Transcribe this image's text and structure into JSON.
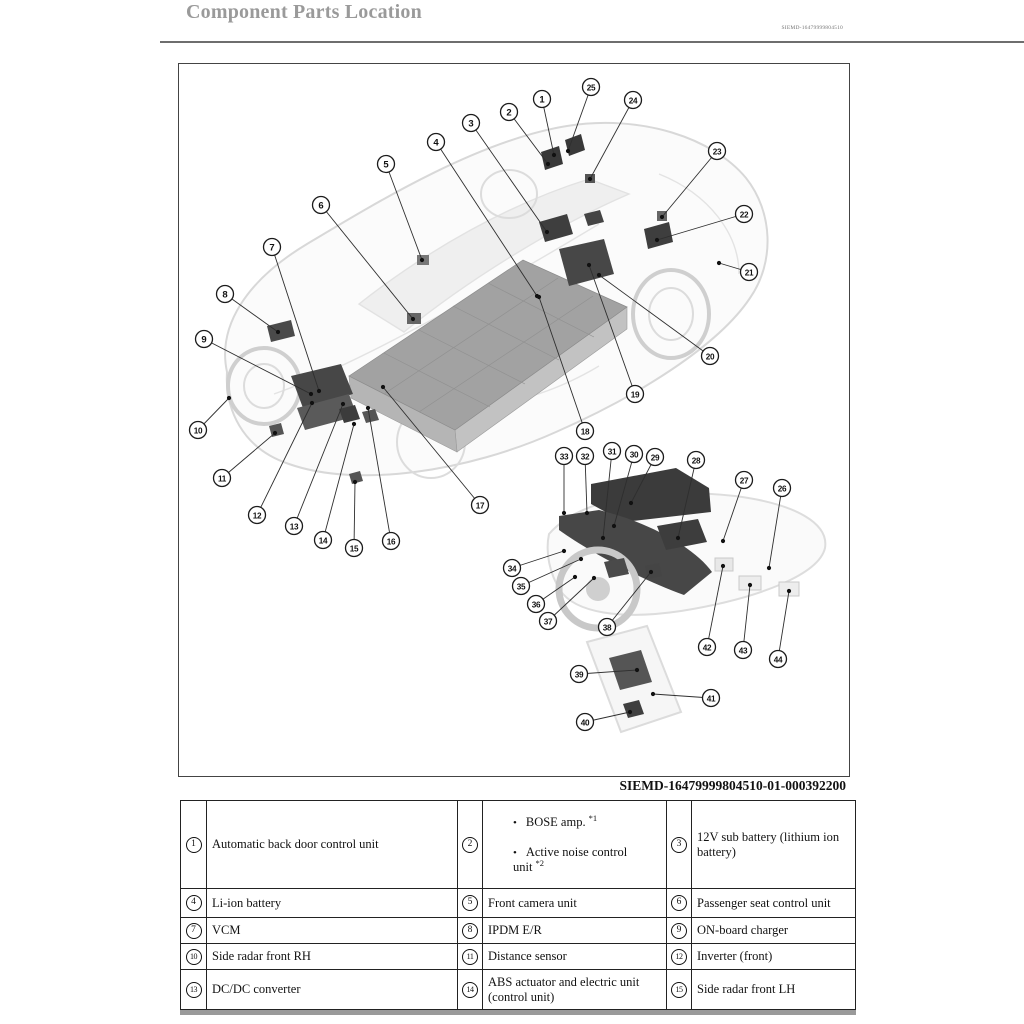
{
  "page": {
    "title": "Component Parts Location",
    "doc_code": "SIEMD-16479999804510",
    "figure_caption": "SIEMD-16479999804510-01-000392200"
  },
  "figure": {
    "callouts": [
      {
        "n": "1",
        "cx": 363,
        "cy": 35,
        "tx": 375,
        "ty": 91
      },
      {
        "n": "2",
        "cx": 330,
        "cy": 48,
        "tx": 369,
        "ty": 100
      },
      {
        "n": "3",
        "cx": 292,
        "cy": 59,
        "tx": 368,
        "ty": 168
      },
      {
        "n": "4",
        "cx": 257,
        "cy": 78,
        "tx": 358,
        "ty": 232
      },
      {
        "n": "5",
        "cx": 207,
        "cy": 100,
        "tx": 243,
        "ty": 196
      },
      {
        "n": "6",
        "cx": 142,
        "cy": 141,
        "tx": 234,
        "ty": 255
      },
      {
        "n": "7",
        "cx": 93,
        "cy": 183,
        "tx": 140,
        "ty": 327
      },
      {
        "n": "8",
        "cx": 46,
        "cy": 230,
        "tx": 99,
        "ty": 268
      },
      {
        "n": "9",
        "cx": 25,
        "cy": 275,
        "tx": 132,
        "ty": 330
      },
      {
        "n": "10",
        "cx": 19,
        "cy": 366,
        "tx": 50,
        "ty": 334
      },
      {
        "n": "11",
        "cx": 43,
        "cy": 414,
        "tx": 96,
        "ty": 369
      },
      {
        "n": "12",
        "cx": 78,
        "cy": 451,
        "tx": 133,
        "ty": 339
      },
      {
        "n": "13",
        "cx": 115,
        "cy": 462,
        "tx": 164,
        "ty": 340
      },
      {
        "n": "14",
        "cx": 144,
        "cy": 476,
        "tx": 175,
        "ty": 360
      },
      {
        "n": "15",
        "cx": 175,
        "cy": 484,
        "tx": 176,
        "ty": 418
      },
      {
        "n": "16",
        "cx": 212,
        "cy": 477,
        "tx": 189,
        "ty": 344
      },
      {
        "n": "17",
        "cx": 301,
        "cy": 441,
        "tx": 204,
        "ty": 323
      },
      {
        "n": "18",
        "cx": 406,
        "cy": 367,
        "tx": 360,
        "ty": 233
      },
      {
        "n": "19",
        "cx": 456,
        "cy": 330,
        "tx": 410,
        "ty": 201
      },
      {
        "n": "20",
        "cx": 531,
        "cy": 292,
        "tx": 420,
        "ty": 211
      },
      {
        "n": "21",
        "cx": 570,
        "cy": 208,
        "tx": 540,
        "ty": 199
      },
      {
        "n": "22",
        "cx": 565,
        "cy": 150,
        "tx": 478,
        "ty": 176
      },
      {
        "n": "23",
        "cx": 538,
        "cy": 87,
        "tx": 483,
        "ty": 153
      },
      {
        "n": "24",
        "cx": 454,
        "cy": 36,
        "tx": 411,
        "ty": 115
      },
      {
        "n": "25",
        "cx": 412,
        "cy": 23,
        "tx": 389,
        "ty": 87
      },
      {
        "n": "26",
        "cx": 603,
        "cy": 424,
        "tx": 590,
        "ty": 504
      },
      {
        "n": "27",
        "cx": 565,
        "cy": 416,
        "tx": 544,
        "ty": 477
      },
      {
        "n": "28",
        "cx": 517,
        "cy": 396,
        "tx": 499,
        "ty": 474
      },
      {
        "n": "29",
        "cx": 476,
        "cy": 393,
        "tx": 452,
        "ty": 439
      },
      {
        "n": "30",
        "cx": 455,
        "cy": 390,
        "tx": 435,
        "ty": 462
      },
      {
        "n": "31",
        "cx": 433,
        "cy": 387,
        "tx": 424,
        "ty": 474
      },
      {
        "n": "32",
        "cx": 406,
        "cy": 392,
        "tx": 408,
        "ty": 449
      },
      {
        "n": "33",
        "cx": 385,
        "cy": 392,
        "tx": 385,
        "ty": 449
      },
      {
        "n": "34",
        "cx": 333,
        "cy": 504,
        "tx": 385,
        "ty": 487
      },
      {
        "n": "35",
        "cx": 342,
        "cy": 522,
        "tx": 402,
        "ty": 495
      },
      {
        "n": "36",
        "cx": 357,
        "cy": 540,
        "tx": 396,
        "ty": 513
      },
      {
        "n": "37",
        "cx": 369,
        "cy": 557,
        "tx": 415,
        "ty": 514
      },
      {
        "n": "38",
        "cx": 428,
        "cy": 563,
        "tx": 472,
        "ty": 508
      },
      {
        "n": "39",
        "cx": 400,
        "cy": 610,
        "tx": 458,
        "ty": 606
      },
      {
        "n": "40",
        "cx": 406,
        "cy": 658,
        "tx": 451,
        "ty": 648
      },
      {
        "n": "41",
        "cx": 532,
        "cy": 634,
        "tx": 474,
        "ty": 630
      },
      {
        "n": "42",
        "cx": 528,
        "cy": 583,
        "tx": 544,
        "ty": 502
      },
      {
        "n": "43",
        "cx": 564,
        "cy": 586,
        "tx": 571,
        "ty": 521
      },
      {
        "n": "44",
        "cx": 599,
        "cy": 595,
        "tx": 610,
        "ty": 527
      }
    ]
  },
  "table": {
    "rows": [
      {
        "cells": [
          {
            "num": "1",
            "label": "Automatic back door control unit"
          },
          {
            "num": "2",
            "bullets": [
              {
                "text": "BOSE amp.",
                "sup": "*1"
              },
              {
                "text": "Active noise control unit",
                "sup": "*2"
              }
            ]
          },
          {
            "num": "3",
            "label": "12V sub battery (lithium ion battery)"
          }
        ]
      },
      {
        "cells": [
          {
            "num": "4",
            "label": "Li-ion battery"
          },
          {
            "num": "5",
            "label": "Front camera unit"
          },
          {
            "num": "6",
            "label": "Passenger seat control unit"
          }
        ]
      },
      {
        "cells": [
          {
            "num": "7",
            "label": "VCM"
          },
          {
            "num": "8",
            "label": "IPDM E/R"
          },
          {
            "num": "9",
            "label": "ON-board charger"
          }
        ]
      },
      {
        "cells": [
          {
            "num": "10",
            "label": "Side radar front RH"
          },
          {
            "num": "11",
            "label": "Distance sensor"
          },
          {
            "num": "12",
            "label": "Inverter (front)"
          }
        ]
      },
      {
        "cells": [
          {
            "num": "13",
            "label": "DC/DC converter"
          },
          {
            "num": "14",
            "label": "ABS actuator and electric unit (control unit)"
          },
          {
            "num": "15",
            "label": "Side radar front LH"
          }
        ]
      }
    ]
  },
  "colors": {
    "title_gray": "#9a9a9a",
    "rule_gray": "#6e6e6e",
    "ghost_line": "#d8d8d8",
    "battery_gray": "#a2a2a2",
    "dark_component": "#3f3f3f",
    "continuation_bar": "#9a9a9a"
  }
}
